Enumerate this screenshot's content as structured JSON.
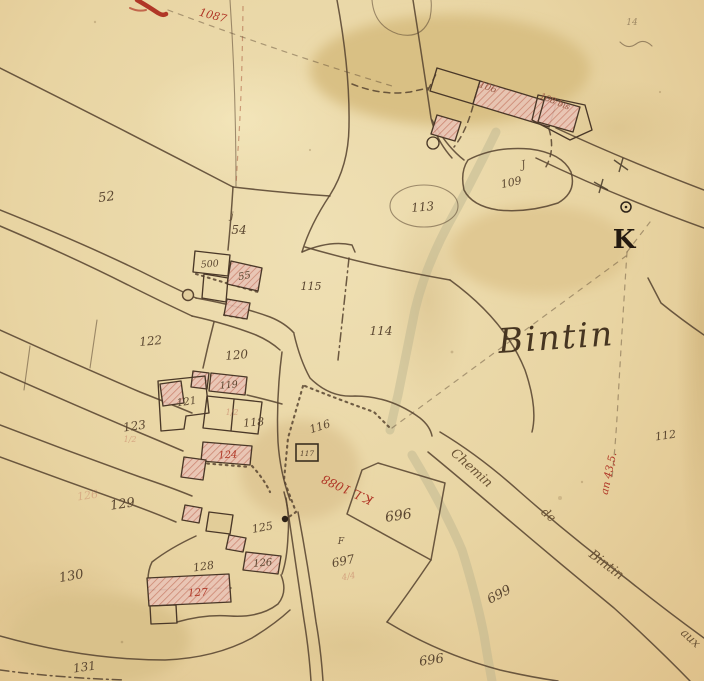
{
  "meta": {
    "description": "Hand-drawn cadastral map sheet, section K, hamlet of Bintin",
    "place_name": "Bintin",
    "section_letter": "K"
  },
  "colors": {
    "paper": "#e8d4a2",
    "ink": "#5b4731",
    "red_annotation": "#b03727",
    "building_fill": "#e9c4b6",
    "building_hatch": "#c97f6e",
    "stream": "#b6b18d"
  },
  "labels": [
    {
      "name": "parcel-52",
      "text": "52",
      "x": 107,
      "y": 201,
      "rot": -8,
      "size": 13,
      "cls": "ink"
    },
    {
      "name": "parcel-54",
      "text": "54",
      "x": 239,
      "y": 234,
      "rot": 0,
      "size": 12,
      "cls": "ink"
    },
    {
      "name": "jardin-mark-54",
      "text": "j",
      "x": 232,
      "y": 219,
      "rot": 0,
      "size": 10,
      "cls": "ink",
      "op": 0.8
    },
    {
      "name": "building-500",
      "text": "500",
      "x": 210,
      "y": 267,
      "rot": -5,
      "size": 9.5,
      "cls": "ink"
    },
    {
      "name": "building-55",
      "text": "55",
      "x": 245,
      "y": 279,
      "rot": -10,
      "size": 10,
      "cls": "ink"
    },
    {
      "name": "parcel-115",
      "text": "115",
      "x": 311,
      "y": 290,
      "rot": 0,
      "size": 11,
      "cls": "ink"
    },
    {
      "name": "parcel-114",
      "text": "114",
      "x": 381,
      "y": 335,
      "rot": 0,
      "size": 12,
      "cls": "ink"
    },
    {
      "name": "parcel-113",
      "text": "113",
      "x": 423,
      "y": 211,
      "rot": -5,
      "size": 12,
      "cls": "ink"
    },
    {
      "name": "parcel-109",
      "text": "109",
      "x": 512,
      "y": 186,
      "rot": -12,
      "size": 11,
      "cls": "ink"
    },
    {
      "name": "jardin-mark-109",
      "text": "J",
      "x": 524,
      "y": 168,
      "rot": -12,
      "size": 11,
      "cls": "ink",
      "op": 0.85
    },
    {
      "name": "building-106",
      "text": "106",
      "x": 487,
      "y": 90,
      "rot": 20,
      "size": 9.5,
      "cls": "bnum"
    },
    {
      "name": "building-108",
      "text": "108 bis",
      "x": 554,
      "y": 104,
      "rot": 22,
      "size": 8.5,
      "cls": "bnum"
    },
    {
      "name": "parcel-112",
      "text": "112",
      "x": 666,
      "y": 439,
      "rot": -8,
      "size": 11,
      "cls": "ink"
    },
    {
      "name": "parcel-116",
      "text": "116",
      "x": 321,
      "y": 430,
      "rot": -18,
      "size": 11,
      "cls": "ink"
    },
    {
      "name": "parcel-117",
      "text": "117",
      "x": 307,
      "y": 456,
      "rot": 0,
      "size": 7.5,
      "cls": "ink"
    },
    {
      "name": "parcel-122",
      "text": "122",
      "x": 151,
      "y": 345,
      "rot": -5,
      "size": 12,
      "cls": "ink"
    },
    {
      "name": "parcel-120",
      "text": "120",
      "x": 237,
      "y": 359,
      "rot": -5,
      "size": 12,
      "cls": "ink"
    },
    {
      "name": "building-119",
      "text": "119",
      "x": 229,
      "y": 388,
      "rot": -5,
      "size": 9.5,
      "cls": "ink"
    },
    {
      "name": "building-121",
      "text": "121",
      "x": 187,
      "y": 405,
      "rot": -8,
      "size": 10.5,
      "cls": "ink"
    },
    {
      "name": "parcel-123",
      "text": "123",
      "x": 135,
      "y": 430,
      "rot": -8,
      "size": 12,
      "cls": "ink"
    },
    {
      "name": "parcel-118",
      "text": "118",
      "x": 254,
      "y": 426,
      "rot": -5,
      "size": 11,
      "cls": "ink"
    },
    {
      "name": "building-124",
      "text": "124",
      "x": 228,
      "y": 458,
      "rot": -3,
      "size": 10,
      "cls": "red"
    },
    {
      "name": "building-125",
      "text": "125",
      "x": 263,
      "y": 531,
      "rot": -10,
      "size": 11,
      "cls": "ink"
    },
    {
      "name": "building-126",
      "text": "126",
      "x": 263,
      "y": 566,
      "rot": -5,
      "size": 10,
      "cls": "ink"
    },
    {
      "name": "building-127",
      "text": "127",
      "x": 198,
      "y": 596,
      "rot": -3,
      "size": 10.5,
      "cls": "red"
    },
    {
      "name": "parcel-128",
      "text": "128",
      "x": 204,
      "y": 570,
      "rot": -8,
      "size": 11,
      "cls": "ink"
    },
    {
      "name": "parcel-129",
      "text": "129",
      "x": 123,
      "y": 508,
      "rot": -8,
      "size": 13,
      "cls": "ink"
    },
    {
      "name": "parcel-130",
      "text": "130",
      "x": 72,
      "y": 580,
      "rot": -10,
      "size": 13,
      "cls": "ink"
    },
    {
      "name": "parcel-131",
      "text": "131",
      "x": 85,
      "y": 671,
      "rot": -8,
      "size": 12,
      "cls": "ink"
    },
    {
      "name": "parcel-696",
      "text": "696",
      "x": 399,
      "y": 520,
      "rot": -8,
      "size": 14,
      "cls": "ink"
    },
    {
      "name": "letter-F",
      "text": "F",
      "x": 341,
      "y": 544,
      "rot": 0,
      "size": 9,
      "cls": "ink"
    },
    {
      "name": "parcel-697",
      "text": "697",
      "x": 344,
      "y": 565,
      "rot": -12,
      "size": 12,
      "cls": "ink"
    },
    {
      "name": "parcel-699",
      "text": "699",
      "x": 501,
      "y": 598,
      "rot": -28,
      "size": 13,
      "cls": "ink"
    },
    {
      "name": "parcel-696-bottom",
      "text": "696",
      "x": 432,
      "y": 664,
      "rot": -8,
      "size": 13,
      "cls": "ink"
    },
    {
      "name": "place-name",
      "text": "Bintin",
      "x": 557,
      "y": 349,
      "rot": -4,
      "size": 34,
      "cls": "name"
    },
    {
      "name": "section-letter",
      "text": "K",
      "x": 624,
      "y": 248,
      "rot": 0,
      "size": 26,
      "cls": "k"
    },
    {
      "name": "road-name-chemin",
      "text": "Chemin",
      "x": 469,
      "y": 471,
      "rot": 42,
      "size": 13,
      "cls": "road"
    },
    {
      "name": "road-name-de",
      "text": "de",
      "x": 546,
      "y": 518,
      "rot": 40,
      "size": 12,
      "cls": "road"
    },
    {
      "name": "road-name-bintin",
      "text": "Bintin",
      "x": 604,
      "y": 568,
      "rot": 37,
      "size": 13,
      "cls": "road"
    },
    {
      "name": "road-name-aux",
      "text": "aux",
      "x": 688,
      "y": 641,
      "rot": 42,
      "size": 12,
      "cls": "road"
    },
    {
      "name": "red-note-1087",
      "text": "1087",
      "x": 212,
      "y": 19,
      "rot": 15,
      "size": 11,
      "cls": "red"
    },
    {
      "name": "red-note-1088",
      "text": "K.L 1088",
      "x": 349,
      "y": 486,
      "rot": 205,
      "size": 12,
      "cls": "red"
    },
    {
      "name": "red-note-an435",
      "text": "an 43,5.",
      "x": 612,
      "y": 474,
      "rot": -78,
      "size": 10.5,
      "cls": "red"
    },
    {
      "name": "ghost-number-126",
      "text": "126",
      "x": 88,
      "y": 499,
      "rot": -8,
      "size": 11,
      "cls": "faded",
      "op": 0.4
    },
    {
      "name": "corner-number-14",
      "text": "14",
      "x": 632,
      "y": 25,
      "rot": 0,
      "size": 9,
      "cls": "ink",
      "op": 0.5
    },
    {
      "name": "fraction-118",
      "text": "1/2",
      "x": 232,
      "y": 415,
      "rot": 0,
      "size": 8,
      "cls": "faded",
      "op": 0.55
    },
    {
      "name": "fraction-123",
      "text": "1/2",
      "x": 130,
      "y": 442,
      "rot": 0,
      "size": 8,
      "cls": "faded",
      "op": 0.5
    },
    {
      "name": "fraction-697",
      "text": "4/4",
      "x": 349,
      "y": 579,
      "rot": -10,
      "size": 8.5,
      "cls": "faded",
      "op": 0.55
    }
  ]
}
